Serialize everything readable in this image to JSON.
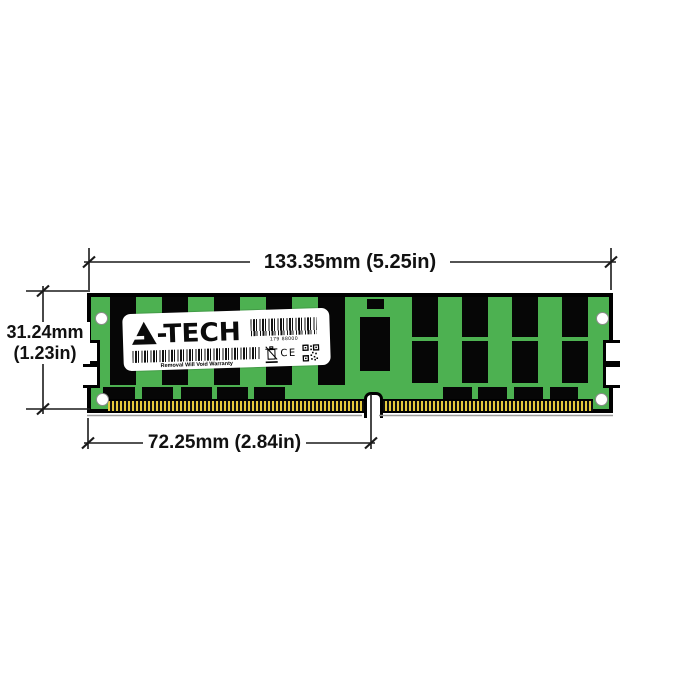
{
  "illustration": {
    "description": "A-Tech server RAM memory module dimension diagram",
    "brand_glyph": "A",
    "brand_suffix": "-TECH",
    "label": {
      "serial_number": "179 88000",
      "warranty_text": "Removal Will Void Warranty",
      "ce_mark": "CE"
    }
  },
  "dimensions": {
    "overall_width": "133.35mm (5.25in)",
    "height_mm": "31.24mm",
    "height_in": "(1.23in)",
    "pin_to_notch": "72.25mm (2.84in)"
  },
  "colors": {
    "pcb_green": "#4DB151",
    "chip_black": "#060606",
    "pin_gold": "#E4C93D",
    "label_white": "#FFFFFF",
    "dimension_line": "#1A1A1A",
    "background": "#FFFFFF"
  }
}
